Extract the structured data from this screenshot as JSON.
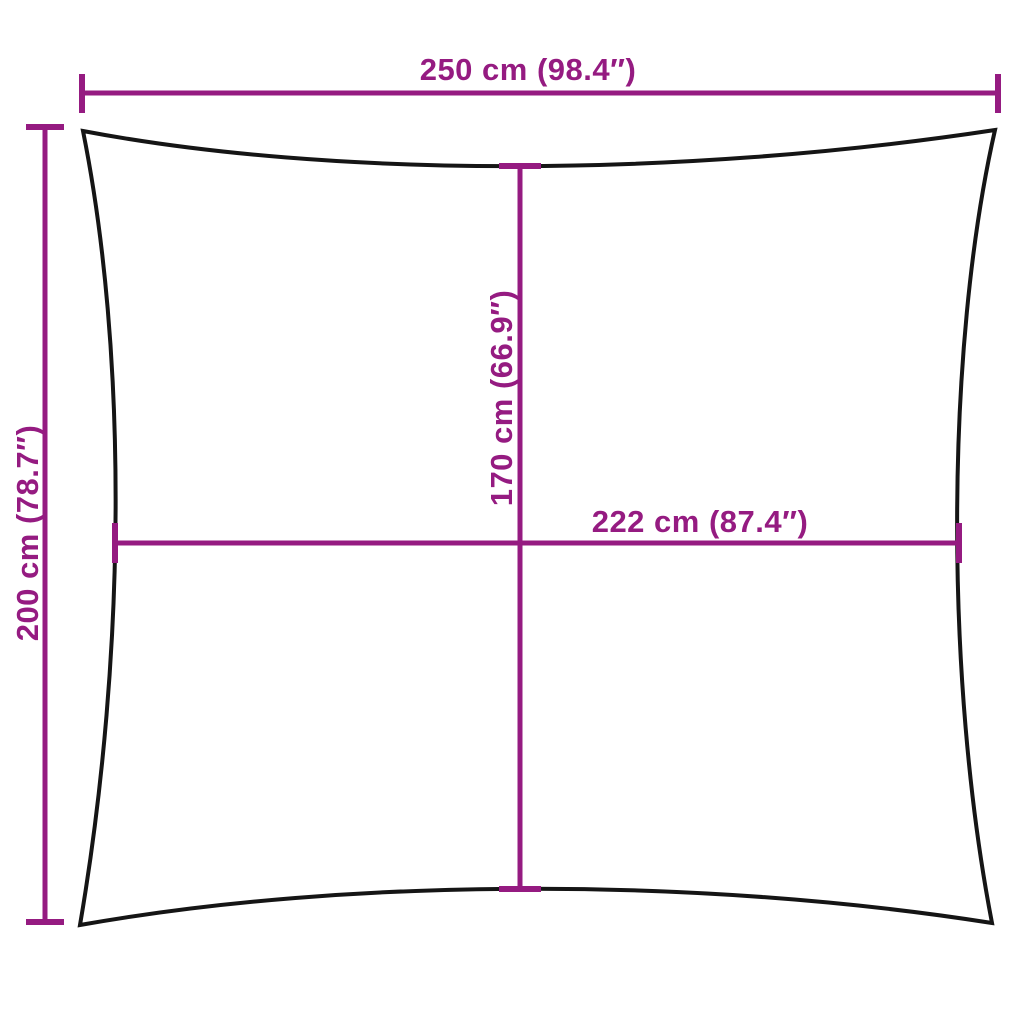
{
  "diagram": {
    "type": "product-dimension-diagram",
    "subject": "rectangular shade sail with concave edges, front view",
    "background": "#ffffff",
    "colors": {
      "dimension": "#951b81",
      "outline": "#151515"
    },
    "dimensions": {
      "top_width": "250 cm (98.4″)",
      "left_height": "200 cm (78.7″)",
      "center_height": "170 cm (66.9″)",
      "center_width": "222 cm (87.4″)"
    }
  }
}
